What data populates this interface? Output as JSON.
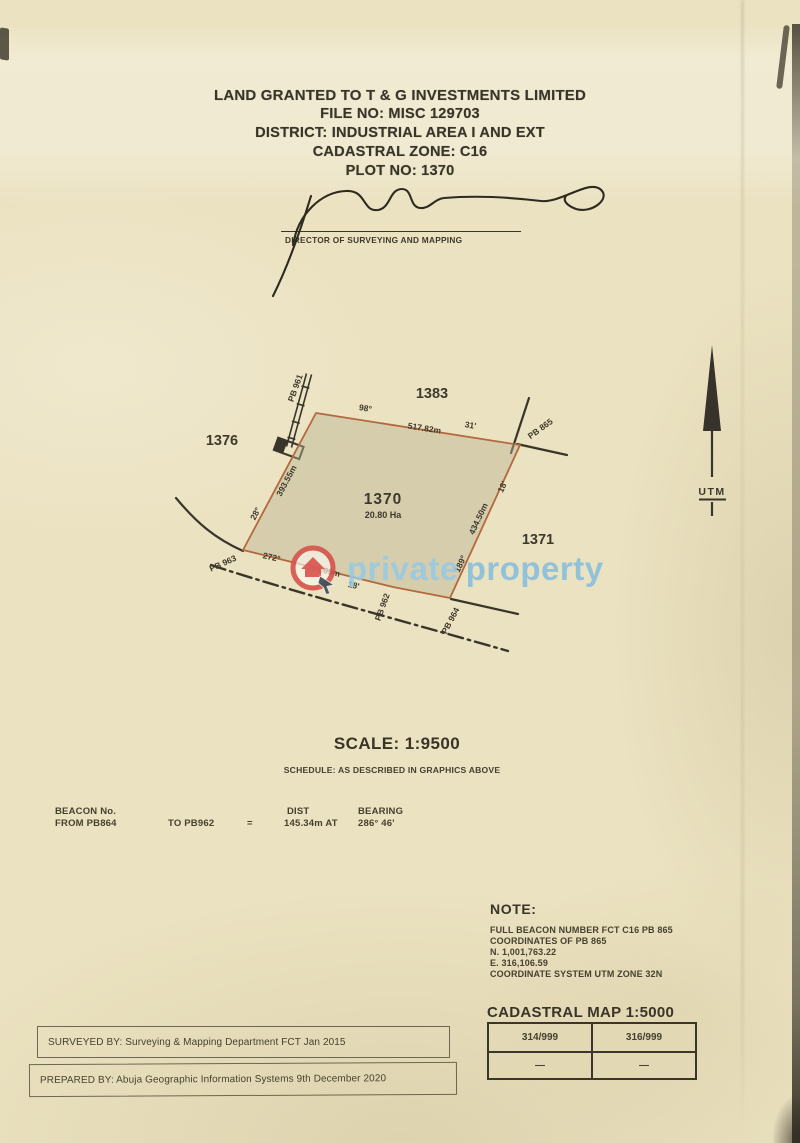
{
  "document": {
    "title_lines": [
      "LAND GRANTED TO T & G INVESTMENTS LIMITED",
      "FILE NO: MISC 129703",
      "DISTRICT: INDUSTRIAL AREA I AND EXT",
      "CADASTRAL ZONE: C16",
      "PLOT NO: 1370"
    ],
    "signature_caption": "DIRECTOR OF SURVEYING AND MAPPING"
  },
  "diagram": {
    "plot_label": "1370",
    "plot_area": "20.80 Ha",
    "neighbor_plots": {
      "top": "1383",
      "left": "1376",
      "right": "1371"
    },
    "north_arrow_label": "UTM",
    "beacons": {
      "top_left": "PB 961",
      "top_right": "PB 865",
      "bottom_left": "PB 963",
      "bottom_middle": "PB 962",
      "bottom_right": "PB 964"
    },
    "edge_labels": {
      "top_deg": "98°",
      "top_dist": "517.82m",
      "top_min": "31'",
      "right_min": "18'",
      "right_dist": "434.50m",
      "right_deg": "189°",
      "left_dist": "393.55m",
      "left_deg": "28°",
      "bottom_deg": "272°",
      "bottom_dist": "391.09m",
      "bottom_min": "18'"
    }
  },
  "watermark": {
    "word1": "private",
    "word2": "property",
    "logo_color": "#d7524c",
    "text_color": "#96c9e4"
  },
  "scale_section": {
    "scale_text": "SCALE: 1:9500",
    "schedule_text": "SCHEDULE: AS DESCRIBED IN GRAPHICS ABOVE"
  },
  "beacon_schedule": {
    "col_beacon": "BEACON No.",
    "col_dist": "DIST",
    "col_bearing": "BEARING",
    "row_from": "FROM PB864",
    "row_to": "TO PB962",
    "row_eq": "=",
    "row_dist": "145.34m AT",
    "row_bearing": "286° 46'"
  },
  "note": {
    "heading": "NOTE:",
    "lines": [
      "FULL BEACON NUMBER FCT C16 PB 865",
      "COORDINATES OF PB 865",
      "N. 1,001,763.22",
      "E. 316,106.59",
      "COORDINATE SYSTEM UTM ZONE 32N"
    ]
  },
  "cadastral_map": {
    "heading": "CADASTRAL MAP 1:5000",
    "cells": [
      [
        "314/999",
        "316/999"
      ],
      [
        "—",
        "—"
      ]
    ]
  },
  "footer": {
    "surveyed_by": "SURVEYED BY: Surveying & Mapping Department FCT  Jan 2015",
    "prepared_by": "PREPARED BY: Abuja Geographic Information Systems  9th December 2020"
  },
  "colors": {
    "paper": "#ebe2c1",
    "ink": "#3b362a",
    "plot_line": "#b4683e"
  }
}
